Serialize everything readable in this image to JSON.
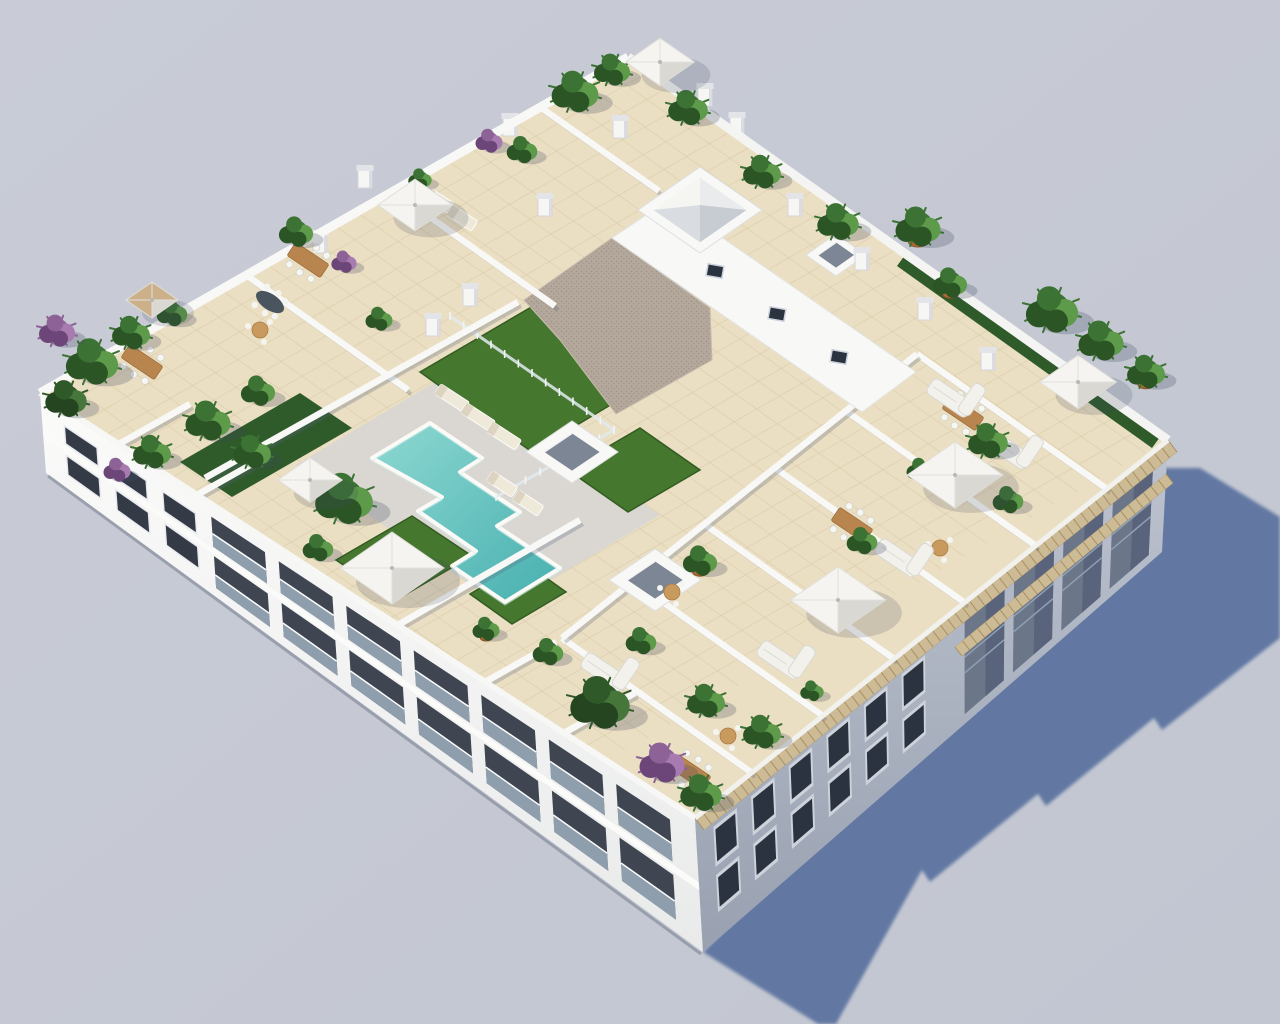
{
  "scene": {
    "kind": "aerial-3d-architectural-render",
    "subject": "white-apartment-block-with-rooftop-pool-terraces",
    "background": {
      "top": "#c9ccd6",
      "bottom": "#c2c6d1"
    },
    "colors": {
      "shadow": "#5e76a1",
      "softShadow": "rgba(62,72,96,0.25)",
      "wall": "#f8f8f6",
      "wallShade": "rgba(90,100,125,0.28)",
      "swTop": "#fbfbfa",
      "swBottom": "#e9eaea",
      "seTop": "#bdc3cf",
      "seBottom": "#99a1b1",
      "window": "#343b47",
      "windowFrame": "#e9ebef",
      "seWindow": "#2c3340",
      "seFrame": "#cdd2db",
      "loggia": "#6b7689",
      "loggiaDark": "#59647c",
      "loggiaRail": "#8fa0b5",
      "railing": "#a2b4c3",
      "tile": "#ebdfc3",
      "tileLine": "#d8caa8",
      "deck": "#dad7d2",
      "gravel": "#b3a89b",
      "gravelDot": "#9d9183",
      "grass": "#46772e",
      "grassDark": "#335c22",
      "hedge": "#2f5a2a",
      "poolLight": "#8ed8d2",
      "poolDeep": "#47b0af",
      "coping": "#fbfaf7",
      "pergola": "#cdbb95",
      "pergolaLine": "#a78f64",
      "parasol": "#f5f4f0",
      "parasolShade": "#d9d8d3",
      "parasolTan": "#cbb089",
      "wood": "#b9854e",
      "sofa": "#f2f1ec",
      "pot": "#ad6a33",
      "chimney": "#f6f6f4",
      "chimneyCap": "#e2e4e8",
      "chimneySide": "#dadce1",
      "skylightInner": "#7d8694",
      "glass": "rgba(225,235,238,0.85)"
    },
    "shadow_polygon": "703,952 1147,500 1157,468 1200,468 1280,517 1280,638 1162,730 1154,718 1046,806 1038,794 930,882 922,870 836,1024 818,1024",
    "pool_points": "372,458 430,423 482,458 460,472 520,512 497,526 560,568 505,602 452,566 476,551 418,511 442,497",
    "deck": [
      296,
      465,
      452,
      372,
      660,
      515,
      504,
      608
    ],
    "gravel": [
      524,
      300,
      612,
      238,
      710,
      308,
      712,
      360,
      616,
      414,
      560,
      340
    ],
    "grass_patches": [
      [
        420,
        372,
        540,
        302,
        652,
        380,
        532,
        452
      ],
      [
        568,
        470,
        640,
        428,
        700,
        470,
        628,
        512
      ],
      [
        336,
        560,
        412,
        516,
        472,
        556,
        396,
        600
      ],
      [
        470,
        594,
        524,
        562,
        566,
        592,
        512,
        624
      ]
    ],
    "hedges": [
      [
        180,
        462,
        300,
        393,
        352,
        428,
        232,
        497
      ],
      [
        905,
        255,
        1160,
        437,
        1152,
        448,
        897,
        266
      ]
    ],
    "core_band": [
      612,
      238,
      668,
      200,
      916,
      372,
      862,
      412
    ],
    "core_windows": [
      [
        715,
        271
      ],
      [
        777,
        314
      ],
      [
        839,
        357
      ]
    ],
    "walls": [
      [
        752,
        773,
        562,
        638
      ],
      [
        823,
        716,
        633,
        581
      ],
      [
        894,
        659,
        704,
        524
      ],
      [
        965,
        603,
        775,
        468
      ],
      [
        1036,
        546,
        846,
        411
      ],
      [
        1107,
        489,
        917,
        354
      ],
      [
        562,
        638,
        917,
        354
      ],
      [
        246,
        275,
        408,
        390
      ],
      [
        393,
        191,
        555,
        306
      ],
      [
        540,
        107,
        659,
        191
      ],
      [
        205,
        478,
        518,
        302
      ],
      [
        398,
        625,
        580,
        520
      ],
      [
        119,
        444,
        190,
        404
      ],
      [
        197,
        495,
        268,
        455
      ],
      [
        485,
        682,
        556,
        642
      ],
      [
        564,
        733,
        635,
        693
      ]
    ],
    "fence": [
      [
        450,
        316,
        614,
        430
      ],
      [
        614,
        430,
        496,
        497
      ]
    ],
    "skylights": [
      {
        "x": 700,
        "y": 210,
        "rx": 62,
        "ry": 43,
        "type": "pyramid"
      },
      {
        "x": 572,
        "y": 452,
        "rx": 46,
        "ry": 31,
        "type": "open"
      },
      {
        "x": 655,
        "y": 580,
        "rx": 46,
        "ry": 31,
        "type": "open"
      },
      {
        "x": 836,
        "y": 255,
        "rx": 30,
        "ry": 21,
        "type": "open"
      }
    ],
    "chimneys": [
      [
        620,
        130
      ],
      [
        705,
        98
      ],
      [
        737,
        127
      ],
      [
        545,
        208
      ],
      [
        470,
        298
      ],
      [
        433,
        328
      ],
      [
        795,
        208
      ],
      [
        862,
        262
      ],
      [
        925,
        312
      ],
      [
        988,
        362
      ],
      [
        320,
        245
      ],
      [
        365,
        180
      ],
      [
        510,
        128
      ]
    ],
    "plants": [
      {
        "x": 575,
        "y": 92,
        "r": 26,
        "t": "g"
      },
      {
        "x": 612,
        "y": 70,
        "r": 20,
        "t": "g"
      },
      {
        "x": 688,
        "y": 108,
        "r": 22,
        "t": "g"
      },
      {
        "x": 522,
        "y": 150,
        "r": 17,
        "t": "g"
      },
      {
        "x": 489,
        "y": 141,
        "r": 15,
        "t": "p"
      },
      {
        "x": 420,
        "y": 179,
        "r": 13,
        "t": "g"
      },
      {
        "x": 762,
        "y": 172,
        "r": 21,
        "t": "g"
      },
      {
        "x": 838,
        "y": 222,
        "r": 23,
        "t": "g"
      },
      {
        "x": 918,
        "y": 227,
        "r": 25,
        "t": "g",
        "pot": true
      },
      {
        "x": 950,
        "y": 283,
        "r": 19,
        "t": "g",
        "pot": true
      },
      {
        "x": 1052,
        "y": 310,
        "r": 29,
        "t": "g"
      },
      {
        "x": 1101,
        "y": 341,
        "r": 25,
        "t": "g"
      },
      {
        "x": 1146,
        "y": 372,
        "r": 21,
        "t": "g",
        "pot": true
      },
      {
        "x": 988,
        "y": 441,
        "r": 22,
        "t": "g"
      },
      {
        "x": 1008,
        "y": 500,
        "r": 17,
        "t": "g"
      },
      {
        "x": 920,
        "y": 470,
        "r": 15,
        "t": "g"
      },
      {
        "x": 862,
        "y": 541,
        "r": 17,
        "t": "g"
      },
      {
        "x": 700,
        "y": 561,
        "r": 19,
        "t": "g",
        "pot": true
      },
      {
        "x": 641,
        "y": 641,
        "r": 17,
        "t": "g"
      },
      {
        "x": 706,
        "y": 701,
        "r": 21,
        "t": "g"
      },
      {
        "x": 92,
        "y": 362,
        "r": 29,
        "t": "g"
      },
      {
        "x": 131,
        "y": 333,
        "r": 21,
        "t": "g"
      },
      {
        "x": 66,
        "y": 399,
        "r": 23,
        "t": "t"
      },
      {
        "x": 172,
        "y": 313,
        "r": 17,
        "t": "g"
      },
      {
        "x": 208,
        "y": 421,
        "r": 25,
        "t": "g"
      },
      {
        "x": 258,
        "y": 391,
        "r": 19,
        "t": "g"
      },
      {
        "x": 152,
        "y": 452,
        "r": 21,
        "t": "g"
      },
      {
        "x": 117,
        "y": 470,
        "r": 15,
        "t": "p"
      },
      {
        "x": 344,
        "y": 499,
        "r": 32,
        "t": "g"
      },
      {
        "x": 252,
        "y": 452,
        "r": 21,
        "t": "g"
      },
      {
        "x": 318,
        "y": 548,
        "r": 17,
        "t": "g"
      },
      {
        "x": 379,
        "y": 319,
        "r": 15,
        "t": "g"
      },
      {
        "x": 600,
        "y": 703,
        "r": 33,
        "t": "t"
      },
      {
        "x": 662,
        "y": 763,
        "r": 25,
        "t": "p"
      },
      {
        "x": 701,
        "y": 793,
        "r": 23,
        "t": "g"
      },
      {
        "x": 548,
        "y": 652,
        "r": 17,
        "t": "g"
      },
      {
        "x": 486,
        "y": 629,
        "r": 15,
        "t": "g",
        "pot": true
      },
      {
        "x": 762,
        "y": 732,
        "r": 21,
        "t": "g"
      },
      {
        "x": 812,
        "y": 691,
        "r": 13,
        "t": "g"
      },
      {
        "x": 296,
        "y": 232,
        "r": 19,
        "t": "g"
      },
      {
        "x": 344,
        "y": 262,
        "r": 14,
        "t": "p"
      },
      {
        "x": 57,
        "y": 331,
        "r": 20,
        "t": "p"
      }
    ],
    "parasols": [
      {
        "x": 310,
        "y": 480,
        "s": 62,
        "c": "w"
      },
      {
        "x": 392,
        "y": 568,
        "s": 100,
        "c": "w"
      },
      {
        "x": 955,
        "y": 475,
        "s": 92,
        "c": "w"
      },
      {
        "x": 1078,
        "y": 382,
        "s": 74,
        "c": "w"
      },
      {
        "x": 838,
        "y": 600,
        "s": 92,
        "c": "w"
      },
      {
        "x": 660,
        "y": 62,
        "s": 66,
        "c": "w"
      },
      {
        "x": 415,
        "y": 205,
        "s": 72,
        "c": "w"
      },
      {
        "x": 152,
        "y": 300,
        "s": 50,
        "c": "t"
      }
    ],
    "tables": [
      [
        963,
        413
      ],
      [
        852,
        525
      ],
      [
        690,
        772
      ],
      [
        142,
        362
      ],
      [
        308,
        260
      ]
    ],
    "oval_table": [
      270,
      302
    ],
    "round_tables": [
      [
        672,
        592
      ],
      [
        940,
        548
      ],
      [
        728,
        736
      ],
      [
        260,
        330
      ]
    ],
    "sofas": [
      [
        1008,
        450
      ],
      [
        898,
        558
      ],
      [
        780,
        660
      ],
      [
        604,
        672
      ],
      [
        950,
        398
      ]
    ],
    "loungers": [
      [
        452,
        398,
        34
      ],
      [
        478,
        417,
        34
      ],
      [
        504,
        436,
        34
      ],
      [
        502,
        484,
        30
      ],
      [
        528,
        503,
        30
      ],
      [
        438,
        200,
        30
      ],
      [
        462,
        218,
        30
      ]
    ],
    "inventory": {
      "pools": 1,
      "parasols": 8,
      "rooftop_terraces": 9,
      "skylights": 4,
      "chimneys": 13,
      "plants": 42,
      "dining_tables": 5,
      "sofas": 5,
      "sun_loungers": 7
    }
  }
}
